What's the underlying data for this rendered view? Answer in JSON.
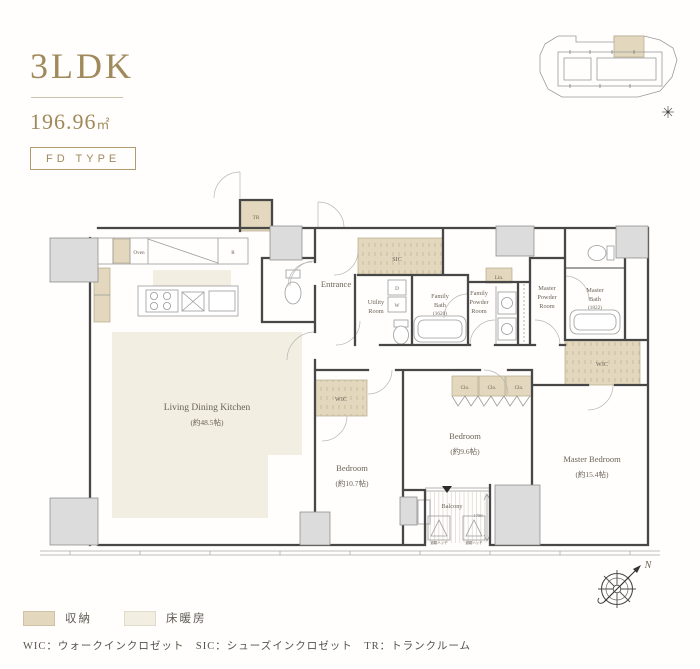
{
  "header": {
    "type": "3LDK",
    "area": "196.96",
    "area_unit": "㎡",
    "plan_type": "FD TYPE"
  },
  "plan": {
    "rooms": {
      "ldk": {
        "name": "Living Dining Kitchen",
        "size": "(約48.5帖)"
      },
      "entrance": {
        "name": "Entrance"
      },
      "utility": {
        "line1": "Utility",
        "line2": "Room"
      },
      "family_bath": {
        "line1": "Family",
        "line2": "Bath",
        "size": "(1620)"
      },
      "family_powder": {
        "line1": "Family",
        "line2": "Powder",
        "line3": "Room"
      },
      "master_powder": {
        "line1": "Master",
        "line2": "Powder",
        "line3": "Room"
      },
      "master_bath": {
        "line1": "Master",
        "line2": "Bath",
        "size": "(1822)"
      },
      "bedroom1": {
        "name": "Bedroom",
        "size": "(約10.7帖)"
      },
      "bedroom2": {
        "name": "Bedroom",
        "size": "(約9.6帖)"
      },
      "master_bedroom": {
        "name": "Master Bedroom",
        "size": "(約15.4帖)"
      },
      "balcony": {
        "name": "Balcony",
        "dimension": "1700"
      }
    },
    "closets": {
      "wic": "WIC",
      "sic": "SIC",
      "tr": "TR",
      "lin": "Lin.",
      "clo": "Clo."
    },
    "appliances": {
      "oven": "Oven",
      "fridge": "R",
      "dryer": "D",
      "washer": "W"
    },
    "escape_hatch": "避難ハッチ",
    "compass_north": "N"
  },
  "legend": {
    "storage_label": "収納",
    "floor_heating_label": "床暖房",
    "abbreviations": "WIC：ウォークインクロゼット　SIC：シューズインクロゼット　TR：トランクルーム"
  },
  "colors": {
    "accent": "#a08a5c",
    "storage": "#e3d8bd",
    "floor_heating": "#f2eee1",
    "wall": "#474747"
  }
}
